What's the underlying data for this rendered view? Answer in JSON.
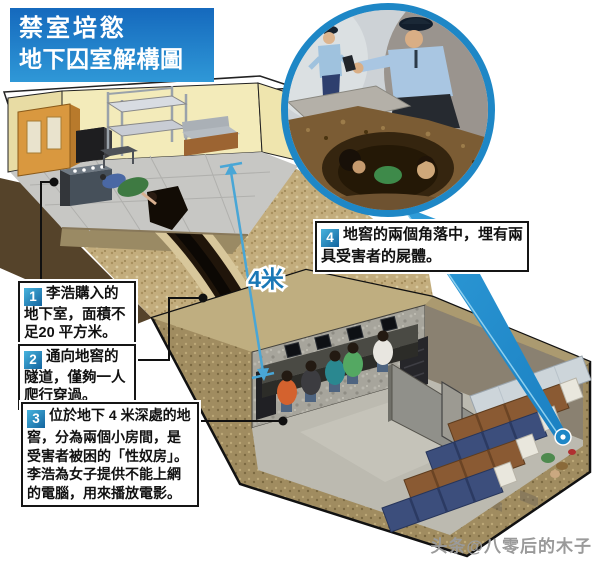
{
  "title": {
    "line1": "禁室培慾",
    "line2": "地下囚室解構圖"
  },
  "annotations": [
    {
      "num": "1",
      "text": "李浩購入的地下室，面積不足20 平方米。"
    },
    {
      "num": "2",
      "text": "通向地窖的隧道，僅夠一人爬行穿過。"
    },
    {
      "num": "3",
      "text": "位於地下 4 米深處的地窖，分為兩個小房間，是受害者被困的「性奴房」。李浩為女子提供不能上網的電腦，用來播放電影。"
    },
    {
      "num": "4",
      "text": "地窖的兩個角落中，埋有兩具受害者的屍體。"
    }
  ],
  "measurement": {
    "depth_label": "4米"
  },
  "watermark": "头条@八零后的木子",
  "colors": {
    "accent": "#1e87c6",
    "accent-dark": "#13649e",
    "title-top": "#1569bd",
    "title-bottom": "#2f98d7",
    "measure": "#49a6d6",
    "measure-text": "#1a78b6",
    "note-border": "#151515",
    "watermark-gray": "#9a9a9a"
  }
}
